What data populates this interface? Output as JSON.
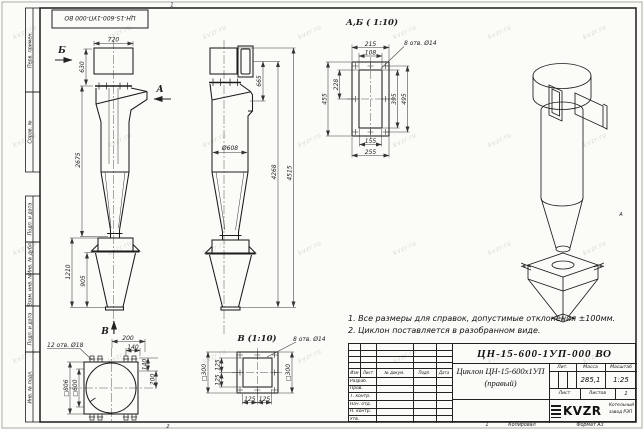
{
  "frame": {
    "stamp_top_left": "ЦН-15-600-1УП-000 ВО",
    "margin_labels": [
      "Перв. примен.",
      "Справ. №",
      "Подп. и дата",
      "Инв. № дубл.",
      "Взам. инв. №",
      "Подп. и дата",
      "Инв. № подл."
    ],
    "zone_top": "1",
    "zone_bottom_left": "2",
    "zone_bottom_mid": "1",
    "zone_right": "А",
    "copied_label": "Копировал",
    "format_label": "Формат А3"
  },
  "views": {
    "side": {
      "arrow_b": "Б",
      "arrow_a": "А",
      "arrow_v": "В",
      "dim_720": "720",
      "dim_630": "630",
      "dim_2675": "2675",
      "dim_1210": "1210",
      "dim_905": "905"
    },
    "front": {
      "dim_665": "665",
      "dim_d608": "Ø608",
      "dim_4268": "4268",
      "dim_4515": "4515"
    },
    "detail_ab": {
      "title": "А,Б ( 1:10)",
      "callout": "8 отв. Ø14",
      "dim_215": "215",
      "dim_108": "108",
      "dim_455": "455",
      "dim_228": "228",
      "dim_395": "395",
      "dim_495": "495",
      "dim_155": "155",
      "dim_255": "255"
    },
    "flange_v": {
      "callout": "12 отв. Ø18",
      "dim_200_top": "200",
      "dim_140_top": "140",
      "dim_140_right": "140",
      "dim_200_right": "200",
      "dim_806": "□806",
      "dim_600": "□600"
    },
    "detail_v": {
      "title": "В (1:10)",
      "callout": "8 отв. Ø14",
      "dim_300_left": "□300",
      "dim_300_right": "□300",
      "dim_125_l1": "125",
      "dim_125_l2": "125",
      "dim_125_b1": "125",
      "dim_125_b2": "125"
    }
  },
  "notes": {
    "line1": "1. Все размеры для справок, допустимые отклонения ±100мм.",
    "line2": "2. Циклон поставляется в разобранном виде."
  },
  "title_block": {
    "doc_number": "ЦН-15-600-1УП-000 ВО",
    "name_line1": "Циклон ЦН-15-600х1УП",
    "name_line2": "(правый)",
    "col_izm": "Изм",
    "col_list": "Лист",
    "col_doc": "№ докум.",
    "col_podp": "Подп.",
    "col_data": "Дата",
    "row_razrab": "Разраб.",
    "row_prov": "Пров.",
    "row_tkontr": "Т. контр.",
    "row_nachotd": "Нач. отд.",
    "row_nkontr": "Н. контр.",
    "row_utv": "Утв.",
    "lit_label": "Лит.",
    "mass_label": "Масса",
    "scale_label": "Масштаб",
    "mass_value": "285,1",
    "scale_value": "1:25",
    "sheet_label": "Лист",
    "sheets_label": "Листов",
    "sheets_value": "1",
    "logo_text": "KVZR",
    "company_line1": "Котельный",
    "company_line2": "завод РЭП"
  },
  "watermark": {
    "text": "kvzr.ru"
  }
}
